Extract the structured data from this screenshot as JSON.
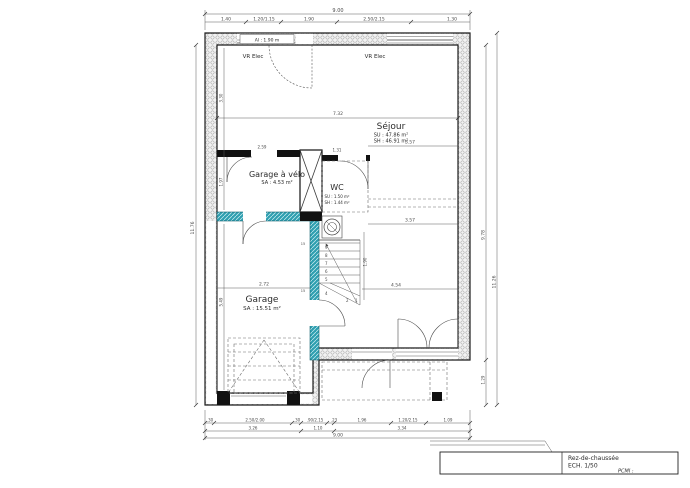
{
  "rooms": {
    "sejour": {
      "name": "Séjour",
      "su": "SU : 47.86 m²",
      "sh": "SH : 46.91 m²"
    },
    "garage_velo": {
      "name": "Garage à vélo",
      "sa": "SA : 4.53 m²"
    },
    "wc": {
      "name": "WC",
      "su": "SU : 1.50 m²",
      "sh": "SH : 1.44 m²"
    },
    "garage": {
      "name": "Garage",
      "sa": "SA : 15.51 m²"
    }
  },
  "labels": {
    "window_height": "Al : 1.90 m",
    "vr_elec_left": "VR Elec",
    "vr_elec_right": "VR Elec"
  },
  "dims": {
    "top_total": "9.00",
    "top_chain": [
      "1.40",
      "1.20/1.15",
      "1.90",
      "2.50/2.15",
      "1.30"
    ],
    "bottom_chain": [
      ".30",
      "2.50/2.00",
      ".30",
      ".90/2.15",
      ".23",
      "1.96",
      "1.20/2.15",
      "1.09"
    ],
    "bottom_sub": [
      "3.26",
      "1.10",
      "3.34"
    ],
    "bottom_total": "9.00",
    "left_total": "11.76",
    "right_inner": "9.78",
    "right_outer": "11.26",
    "right_bottom": "1.29",
    "interior_732": "7.32",
    "interior_357_upper": "3.57",
    "interior_357_lower": "3.57",
    "interior_454": "4.54",
    "interior_272": "2.72",
    "interior_259": "2.59",
    "interior_131": "1.31",
    "interior_330": "3.30",
    "interior_197": "1.97",
    "interior_190": "1.90",
    "interior_549": "5.49",
    "wall_15_a": "15",
    "wall_15_b": "15"
  },
  "stairs": {
    "steps": [
      "9",
      "8",
      "7",
      "6",
      "5",
      "4",
      "2",
      "1"
    ]
  },
  "titleblock": {
    "title": "Rez-de-chaussée",
    "scale": "ECH.  1/50",
    "pcmi": "PCMI :"
  },
  "colors": {
    "wall_hatch_teal": "#2f9fb0",
    "line": "#3a3a3a"
  }
}
